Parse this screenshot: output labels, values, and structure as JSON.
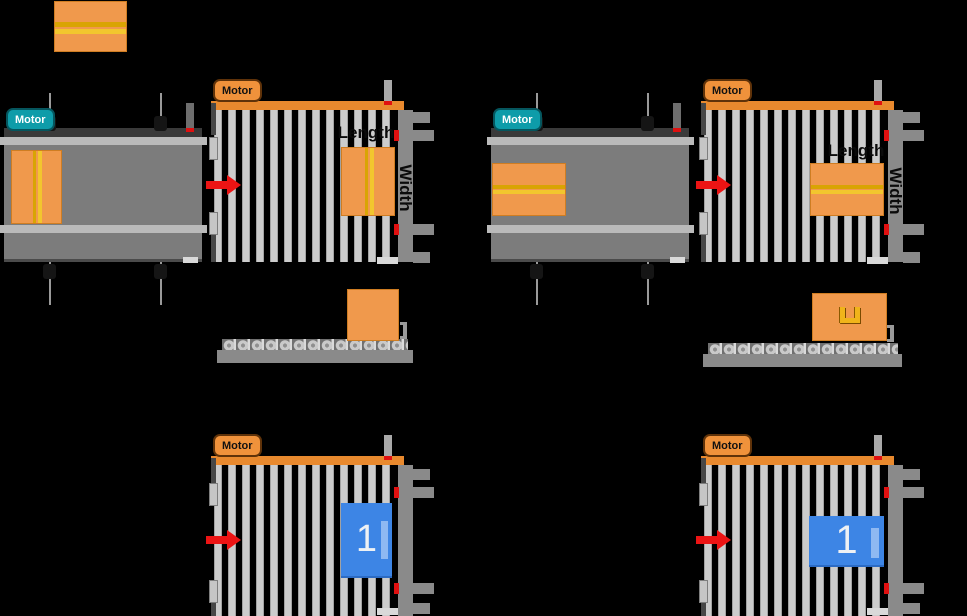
{
  "labels": {
    "motor": "Motor",
    "length": "Length",
    "width": "Width"
  },
  "parcels": {
    "bottom_left_number": "1",
    "bottom_right_number": "1"
  },
  "arrows": {
    "flow_direction": "right"
  },
  "colors": {
    "background": "#000000",
    "carton_orange": "#F0994C",
    "carton_border": "#CF7D22",
    "tape_dark_gold": "#D9A403",
    "tape_yellow": "#F2C62E",
    "drive_belt_orange": "#E8892E",
    "motor_badge_orange": "#F0923B",
    "motor_badge_teal": "#0E9CA9",
    "arrow_red": "#EC1414",
    "parcel_blue": "#3D85E5",
    "parcel_blue_highlight": "#8FB9F2",
    "frame_gray": "#8A8A8A",
    "roller_light_gray": "#CBCBCB",
    "conveyor_body_gray": "#7C7C7C",
    "indicator_red": "#E01010"
  }
}
